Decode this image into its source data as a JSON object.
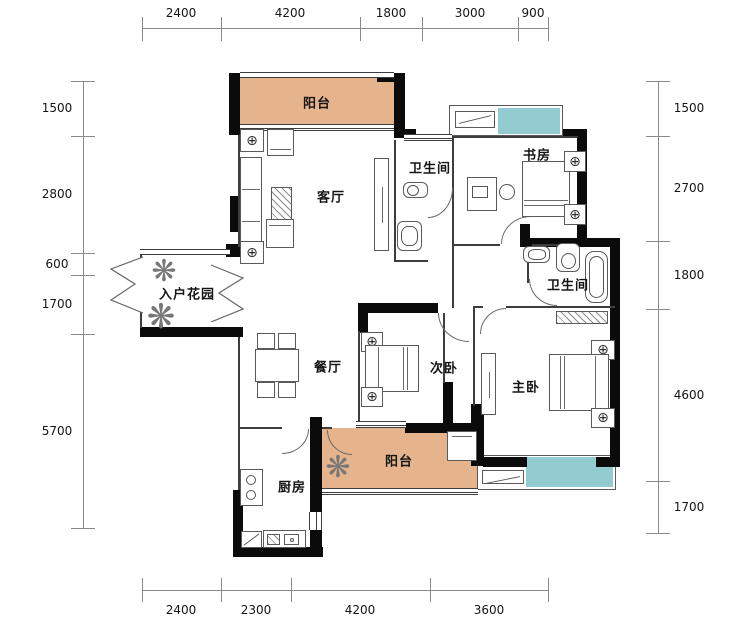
{
  "rooms": {
    "balcony_top": "阳台",
    "living_room": "客厅",
    "bathroom_1": "卫生间",
    "study": "书房",
    "entry_garden": "入户花园",
    "dining_room": "餐厅",
    "bedroom_2": "次卧",
    "bathroom_2": "卫生间",
    "master_bedroom": "主卧",
    "kitchen": "厨房",
    "balcony_bottom": "阳台"
  },
  "dimensions": {
    "top": [
      "2400",
      "4200",
      "1800",
      "3000",
      "900"
    ],
    "bottom": [
      "2400",
      "2300",
      "4200",
      "3600"
    ],
    "left": [
      "1500",
      "2800",
      "600",
      "1700",
      "5700"
    ],
    "right": [
      "1500",
      "2700",
      "1800",
      "4600",
      "1700"
    ]
  },
  "icons": {
    "side_table_lamp": "⊕",
    "plant": "❋"
  },
  "colors": {
    "balcony_fill": "#e6b48c",
    "bay_window_fill": "#92cbd0",
    "wall": "#0b0b0b"
  }
}
